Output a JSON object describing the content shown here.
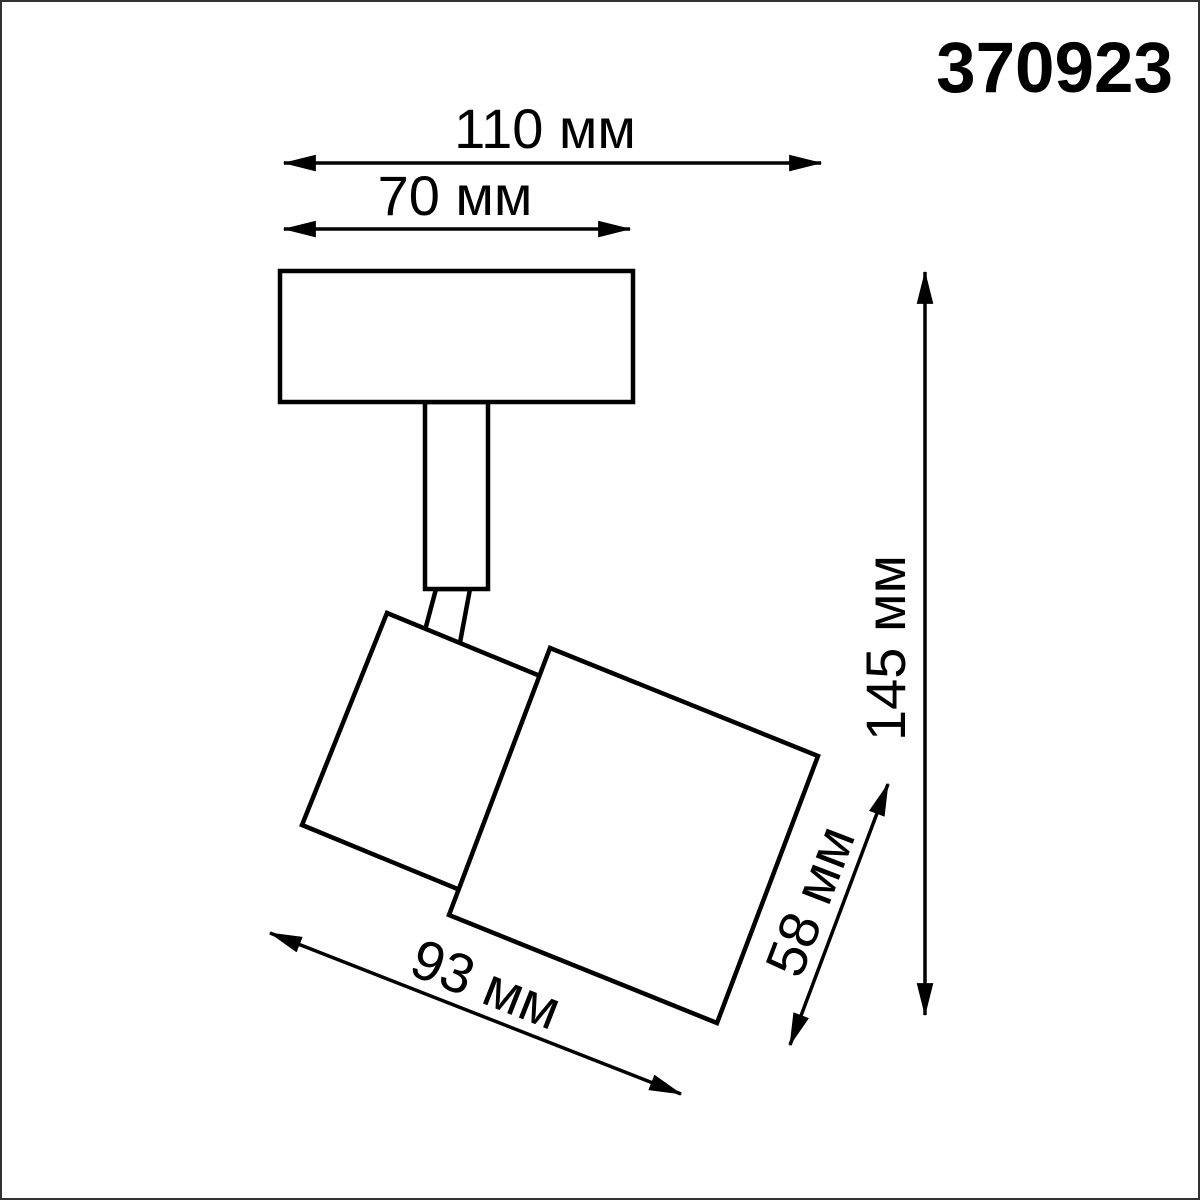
{
  "article": {
    "number": "370923"
  },
  "product": {
    "kind": "spot-luminaire-dimension-drawing",
    "unit": "мм"
  },
  "dimensions": {
    "overall_width": {
      "label": "110 мм",
      "value": 110,
      "unit": "мм"
    },
    "base_width": {
      "label": "70 мм",
      "value": 70,
      "unit": "мм"
    },
    "overall_height": {
      "label": "145 мм",
      "value": 145,
      "unit": "мм"
    },
    "body_length": {
      "label": "93 мм",
      "value": 93,
      "unit": "мм"
    },
    "body_diameter": {
      "label": "58 мм",
      "value": 58,
      "unit": "мм"
    }
  },
  "colors": {
    "line": "#000000",
    "background": "#ffffff",
    "frame": "#333333"
  }
}
